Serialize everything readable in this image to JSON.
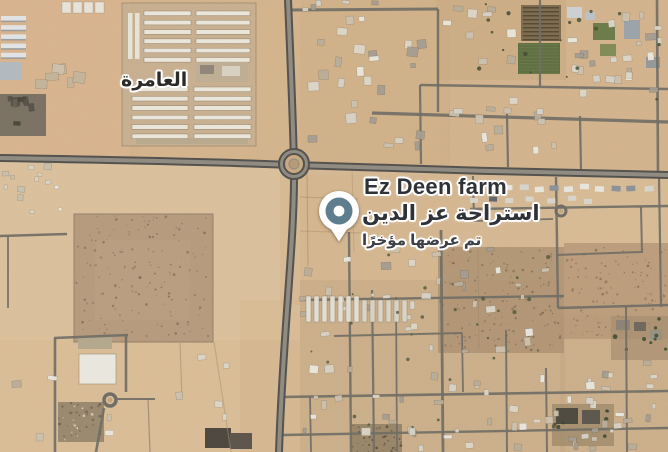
{
  "map": {
    "region_label": {
      "text": "العامرة"
    },
    "poi": {
      "name_en": "Ez Deen farm",
      "name_ar": "استراحة عز الدين",
      "status": "تم عرضها مؤخرًا",
      "pin_color": "#5e7d8d",
      "pin_ring_color": "#ffffff",
      "pin_dot_color": "#ffffff"
    },
    "label_color": "#2f3236",
    "halo_color": "#ffffff"
  }
}
